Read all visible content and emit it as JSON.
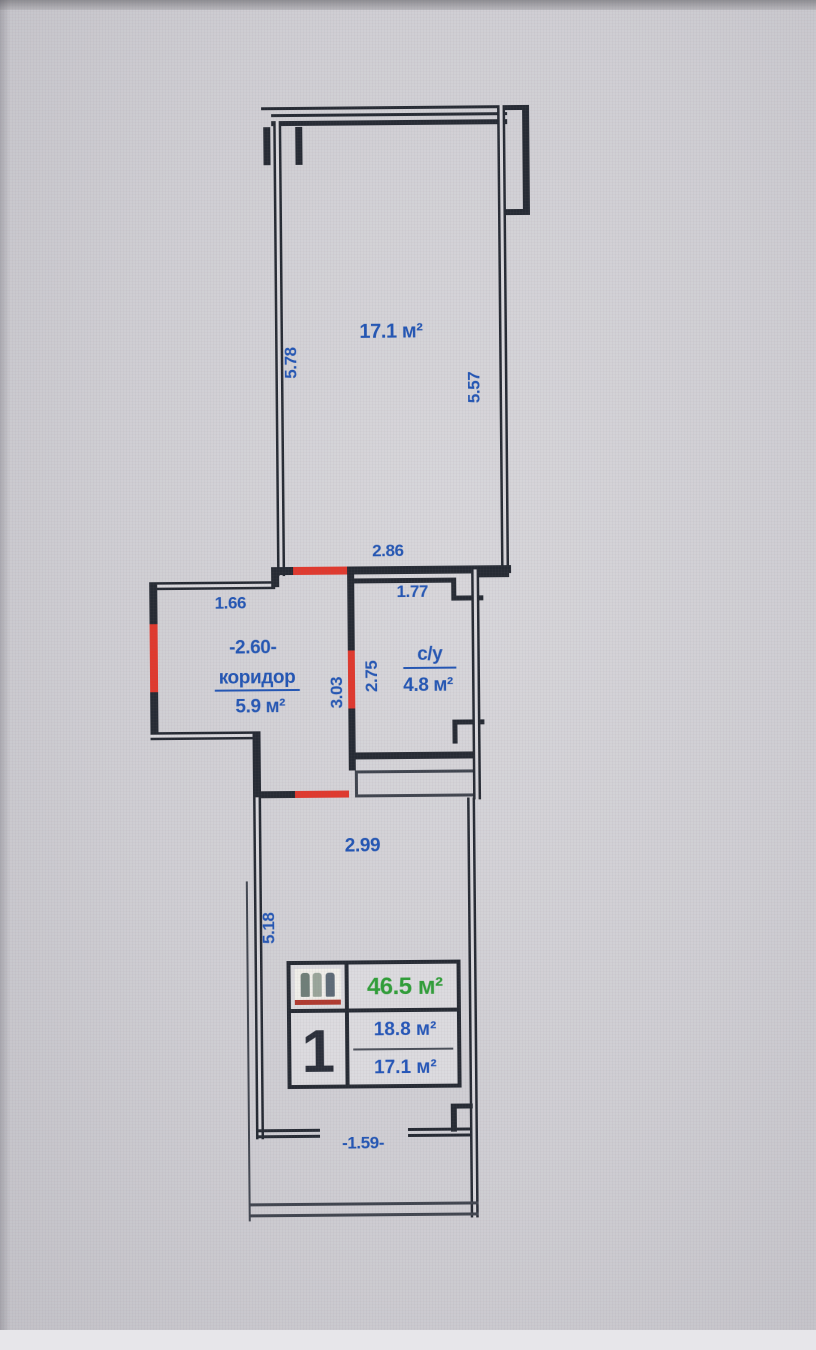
{
  "plan": {
    "upper_room": {
      "area": "17.1 м²",
      "dim_left": "5.78",
      "dim_right": "5.57"
    },
    "middle_dim_top": "2.86",
    "corridor": {
      "name": "коридор",
      "area": "5.9 м²",
      "dim_top": "1.66",
      "dim_width": "-2.60-",
      "dim_right": "3.03"
    },
    "bathroom": {
      "name": "с/у",
      "area": "4.8 м²",
      "dim_top": "1.77",
      "dim_left": "2.75"
    },
    "lower_room": {
      "dim_top": "2.99",
      "dim_left": "5.18",
      "dim_bottom": "-1.59-"
    },
    "legend": {
      "icon": "unit-type-pictogram",
      "unit_number": "1",
      "total_area": "46.5 м²",
      "area_1": "18.8 м²",
      "area_2": "17.1 м²"
    },
    "colors": {
      "wall": "#262b34",
      "dimension_text": "#2356b4",
      "door_opening": "#e0392e",
      "total_area_green": "#2f9e38"
    }
  }
}
